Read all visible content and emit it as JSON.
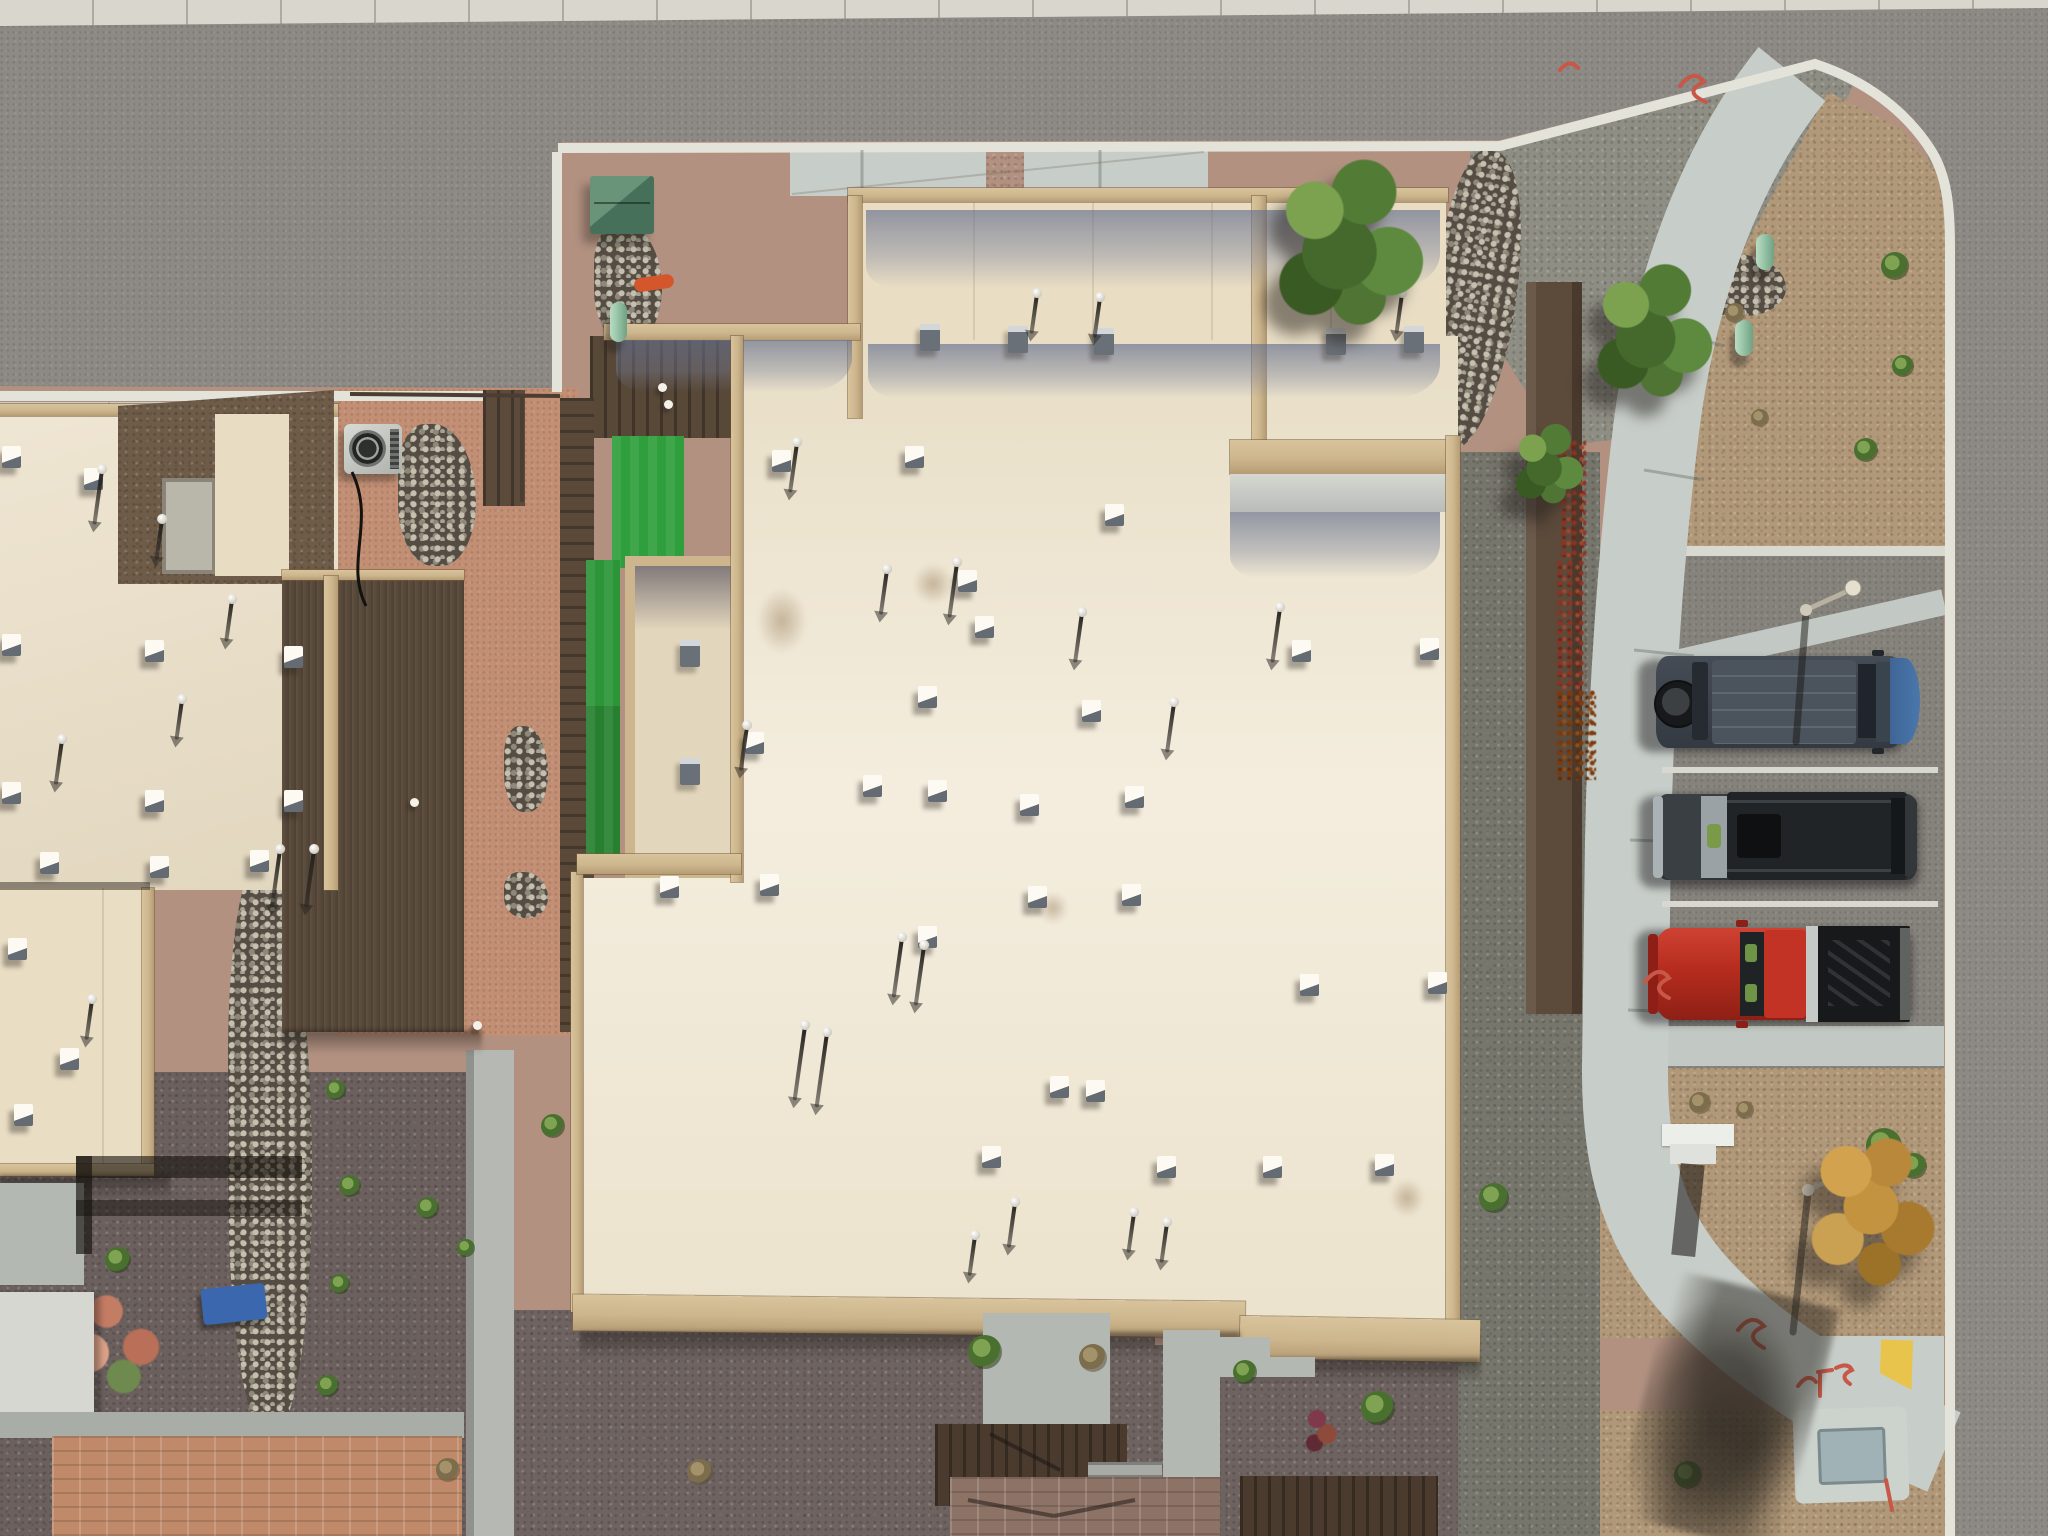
{
  "scene": {
    "kind": "aerial-drone-photograph",
    "subject": "overhead view of flat-roofed desert residential buildings with courtyards, a street corner, sidewalks and three parked vehicles",
    "text_in_image": "none"
  },
  "palette": {
    "concrete": "#d8d6cd",
    "road": "#8d8984",
    "curb": "#e3e3da",
    "walk": "#c7cdc8",
    "walk2": "#c2c8c3",
    "gravel_pink": "#b29181",
    "gravel_tan": "#b19878",
    "gravel_gray": "#8f8e84",
    "gravel_dark": "#77766c",
    "gravel_dark2": "#6e6360",
    "dirt": "#c28f74",
    "roof_cream": "#e9ddc4",
    "roof_bright": "#f1e9d6",
    "roof_patio": "#e2d6bc",
    "parapet": "#cdb68d",
    "shade": "#7e89a8",
    "wall_brown": "#6e5c49",
    "deck": "#5a4939",
    "fence": "#5c4a3b",
    "turf": "#2f9e3c",
    "turf_dark": "#26802f",
    "box_green": "#54806a",
    "bollard": "#9cc7aa",
    "tree_green": "#55803a",
    "tree_orange": "#c4933f",
    "vine": "#8e3322",
    "van_body": "#454c55",
    "van_hood": "#4a77ab",
    "suv_body": "#2f3336",
    "suv_front": "#aab2b6",
    "truck_body": "#b52c1e",
    "truck_bed": "#17191b",
    "yellow_curb": "#e8c44c",
    "spray_red": "#c75848",
    "paver_left": "#c08a6a",
    "paver_center": "#8d7266",
    "path_gray": "#b4b8b2",
    "stone": "#c4bfae"
  },
  "objects": {
    "vehicles": [
      {
        "id": "van",
        "type": "dark van with rear spare tire and blue hood",
        "body": "#454c55",
        "accent": "#4a77ab"
      },
      {
        "id": "suv",
        "type": "charcoal SUV with sunroof and silver nose",
        "body": "#2f3336",
        "accent": "#aab2b6"
      },
      {
        "id": "truck",
        "type": "red pickup truck with black bed",
        "body": "#b52c1e",
        "accent": "#17191b"
      }
    ],
    "vents_white": [
      [
        2,
        446
      ],
      [
        84,
        468
      ],
      [
        2,
        634
      ],
      [
        145,
        640
      ],
      [
        284,
        646
      ],
      [
        2,
        782
      ],
      [
        145,
        790
      ],
      [
        284,
        790
      ],
      [
        40,
        852
      ],
      [
        150,
        856
      ],
      [
        250,
        850
      ],
      [
        8,
        938
      ],
      [
        60,
        1048
      ],
      [
        14,
        1104
      ],
      [
        772,
        450
      ],
      [
        905,
        446
      ],
      [
        1105,
        504
      ],
      [
        958,
        570
      ],
      [
        975,
        616
      ],
      [
        918,
        686
      ],
      [
        1082,
        700
      ],
      [
        745,
        732
      ],
      [
        928,
        780
      ],
      [
        1020,
        794
      ],
      [
        1125,
        786
      ],
      [
        660,
        876
      ],
      [
        760,
        874
      ],
      [
        918,
        926
      ],
      [
        1028,
        886
      ],
      [
        1122,
        884
      ],
      [
        1050,
        1076
      ],
      [
        1086,
        1080
      ],
      [
        863,
        775
      ],
      [
        982,
        1146
      ],
      [
        1157,
        1156
      ],
      [
        1263,
        1156
      ],
      [
        1375,
        1154
      ],
      [
        1292,
        640
      ],
      [
        1420,
        638
      ],
      [
        1300,
        974
      ],
      [
        1428,
        972
      ]
    ],
    "vents_dark": [
      [
        920,
        324
      ],
      [
        1008,
        326
      ],
      [
        1094,
        328
      ],
      [
        1326,
        328
      ],
      [
        1404,
        326
      ],
      [
        680,
        640
      ],
      [
        680,
        758
      ]
    ],
    "pipes": [
      [
        100,
        470,
        55
      ],
      [
        160,
        520,
        40
      ],
      [
        230,
        600,
        42
      ],
      [
        60,
        740,
        45
      ],
      [
        180,
        700,
        40
      ],
      [
        278,
        850,
        58
      ],
      [
        312,
        850,
        58
      ],
      [
        90,
        1000,
        40
      ],
      [
        795,
        443,
        50
      ],
      [
        885,
        570,
        45
      ],
      [
        955,
        563,
        55
      ],
      [
        1080,
        613,
        50
      ],
      [
        1278,
        608,
        55
      ],
      [
        1172,
        703,
        50
      ],
      [
        745,
        726,
        45
      ],
      [
        900,
        938,
        60
      ],
      [
        922,
        946,
        60
      ],
      [
        803,
        1026,
        75
      ],
      [
        825,
        1033,
        75
      ],
      [
        1013,
        1203,
        45
      ],
      [
        973,
        1236,
        40
      ],
      [
        1132,
        1213,
        40
      ],
      [
        1165,
        1223,
        40
      ],
      [
        1035,
        294,
        40
      ],
      [
        1098,
        298,
        40
      ],
      [
        1400,
        294,
        40
      ]
    ],
    "shrubs_green": [
      [
        1895,
        266,
        28
      ],
      [
        1903,
        366,
        22
      ],
      [
        1866,
        450,
        24
      ],
      [
        1884,
        1146,
        36
      ],
      [
        1914,
        1166,
        26
      ],
      [
        1688,
        1475,
        28
      ],
      [
        985,
        1352,
        34
      ],
      [
        1494,
        1198,
        30
      ],
      [
        1245,
        1372,
        24
      ],
      [
        1378,
        1408,
        34
      ],
      [
        553,
        1126,
        24
      ],
      [
        336,
        1090,
        20
      ],
      [
        350,
        1186,
        22
      ],
      [
        340,
        1284,
        20
      ],
      [
        328,
        1386,
        22
      ],
      [
        118,
        1260,
        26
      ],
      [
        428,
        1208,
        22
      ],
      [
        466,
        1248,
        18
      ]
    ],
    "shrubs_dry": [
      [
        1735,
        313,
        20
      ],
      [
        1760,
        418,
        18
      ],
      [
        1700,
        1103,
        22
      ],
      [
        1745,
        1110,
        18
      ],
      [
        1093,
        1358,
        28
      ],
      [
        448,
        1470,
        24
      ],
      [
        700,
        1472,
        26
      ]
    ],
    "white_dots": [
      [
        658,
        383
      ],
      [
        664,
        400
      ],
      [
        473,
        1021
      ],
      [
        410,
        798
      ]
    ],
    "trees": [
      {
        "x": 1262,
        "y": 152,
        "w": 176,
        "h": 182,
        "type": "green"
      },
      {
        "x": 1584,
        "y": 258,
        "w": 140,
        "h": 146,
        "type": "green"
      },
      {
        "x": 1508,
        "y": 420,
        "w": 82,
        "h": 88,
        "type": "green"
      },
      {
        "x": 1788,
        "y": 1118,
        "w": 166,
        "h": 178,
        "type": "orange"
      }
    ]
  }
}
